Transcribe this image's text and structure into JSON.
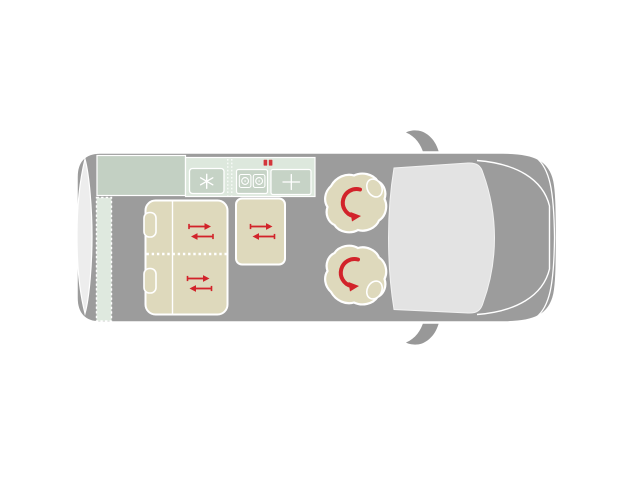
{
  "page": {
    "background": "#ffffff",
    "description": "Campervan floor plan, top view"
  },
  "floorplan": {
    "colors": {
      "van_body": "#9c9c9c",
      "mirror_gray": "#989898",
      "outline_white": "#ffffff",
      "windshield": "#e3e3e3",
      "rear_door": "#ededed",
      "counter_sage": "#c3d0c3",
      "kitchen_pale": "#dde8dd",
      "kitchen_box": "#c6d3c6",
      "shelf_pale": "#dfe9df",
      "upholstery_beige": "#ded9bc",
      "accent_red": "#d2232a"
    },
    "regions": {
      "vehicle": "campervan top view",
      "rear_door": "rear door",
      "rear_shelf": "rear shelf",
      "counter": "kitchen counter",
      "kitchen_unit": "kitchen unit",
      "fridge": "fridge",
      "hob": "two-burner hob",
      "sink": "sink",
      "bed": "bench bed",
      "side_seat": "side seat",
      "swivel_seat_rear": "swivel seat rear",
      "swivel_seat_front": "swivel seat front",
      "windshield": "windshield",
      "mirror_top": "side mirror",
      "mirror_bottom": "side mirror"
    },
    "icons": {
      "fridge": "snowflake-icon",
      "hob": "burner-icon",
      "sink": "faucet-cross-icon",
      "slide": "slide-arrows-icon",
      "swivel": "swivel-arrow-icon",
      "hob_badge": "red-indicator-badge"
    }
  }
}
